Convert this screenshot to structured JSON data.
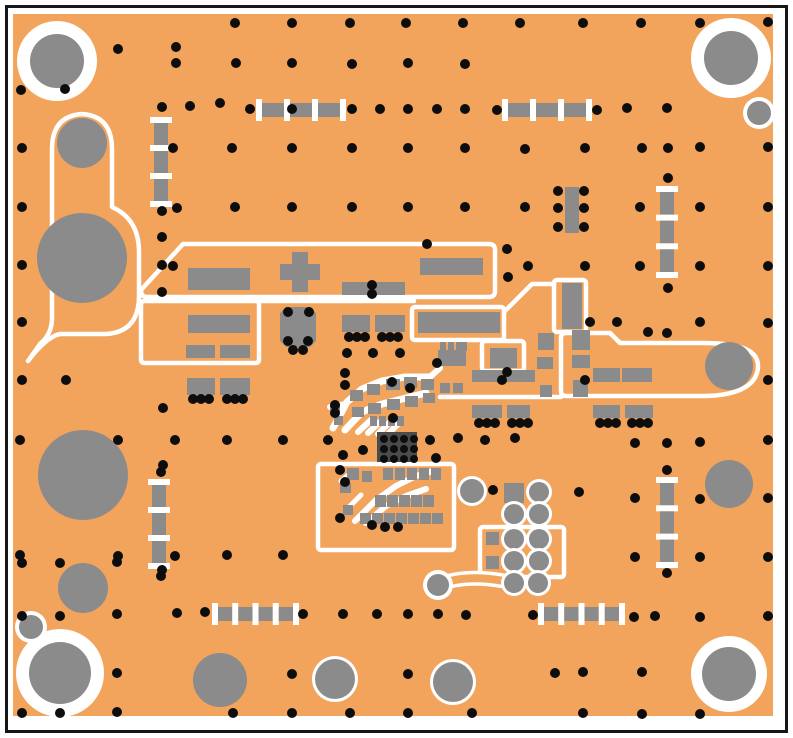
{
  "app": {
    "name": "pcb-layout-view"
  },
  "colors": {
    "background": "#ffffff",
    "frame": "#161616",
    "board_orange": "#F2A45C",
    "pad_gray": "#8B8B8B",
    "via_black": "#0D0D0D",
    "silkscreen_white": "#FFFFFF",
    "ic_grid_dark": "#4B4B4B"
  },
  "board": {
    "width": 793,
    "height": 738,
    "frame": [
      6.5,
      6.5,
      780,
      725
    ],
    "surface": [
      13,
      14,
      760,
      702
    ]
  },
  "silkscreen": {
    "paths": [
      "M28,361 Q46,337 60,334 L106,334 Q139,332 139,296 L139,252 Q139,219 112,207 L112,149 Q112,116 82,114 Q52,116 52,149 L52,318 Q52,334 40,344 L28,361",
      "M141,290 L183,244 L489,244 Q495,244 495,250 L495,291 Q495,297 489,297 L147,297 Q141,297 141,290 Z",
      "M259,301 H414",
      "M504,312 L532,284 H554",
      "M561,338 Q561,333 566,333 H610 L620,343 H702 C745,343 758,352 758,366 C758,381 745,396 702,396 H566 Q561,396 561,391 Z",
      "M440,397 H561"
    ],
    "rects": [
      [
        141,
        301,
        118,
        62
      ],
      [
        412,
        307,
        92,
        33
      ],
      [
        554,
        280,
        32,
        52
      ],
      [
        482,
        341,
        42,
        30
      ],
      [
        318,
        464,
        136,
        86
      ],
      [
        480,
        527,
        84,
        50
      ]
    ]
  },
  "traces": [
    [
      "M333,428 L347,402 L362,389 L382,381 L405,377 L430,377",
      7
    ],
    [
      "M345,430 L362,412 L382,404 L406,398 L426,393",
      7
    ],
    [
      "M358,432 L372,419",
      6
    ],
    [
      "M368,433 L382,420",
      6
    ],
    [
      "M378,434 L391,421",
      6
    ],
    [
      "M388,434 L400,422",
      6
    ],
    [
      "M330,407 L346,404",
      6
    ],
    [
      "M430,377 L440,368",
      6
    ],
    [
      "M355,521 L376,500 L396,486 L416,476 L433,471",
      6
    ],
    [
      "M366,523 L386,506 L406,496 L426,489",
      6
    ],
    [
      "M350,506 L361,495",
      5
    ],
    [
      "M341,481 L351,473",
      5
    ]
  ],
  "dumbbell": {
    "path": "M438,585 Q464,574 504,581",
    "outer": 15,
    "inner": 8,
    "pad": [
      438,
      585,
      11,
      4
    ]
  },
  "pads": [
    [
      188,
      268,
      62,
      22
    ],
    [
      292,
      252,
      16,
      40
    ],
    [
      280,
      264,
      40,
      16
    ],
    [
      342,
      282,
      63,
      13
    ],
    [
      420,
      258,
      63,
      17
    ],
    [
      188,
      315,
      62,
      18
    ],
    [
      186,
      345,
      29,
      13
    ],
    [
      220,
      345,
      30,
      13
    ],
    [
      187,
      378,
      28,
      17
    ],
    [
      220,
      378,
      30,
      17
    ],
    [
      342,
      315,
      28,
      17
    ],
    [
      375,
      315,
      30,
      17
    ],
    [
      418,
      312,
      82,
      21
    ],
    [
      438,
      350,
      28,
      16
    ],
    [
      440,
      342,
      6,
      9
    ],
    [
      448,
      342,
      6,
      9
    ],
    [
      456,
      342,
      6,
      9
    ],
    [
      462,
      342,
      5,
      9
    ],
    [
      440,
      383,
      10,
      10
    ],
    [
      453,
      383,
      10,
      10
    ],
    [
      490,
      348,
      27,
      20
    ],
    [
      472,
      370,
      30,
      12
    ],
    [
      504,
      370,
      31,
      12
    ],
    [
      538,
      333,
      16,
      17
    ],
    [
      537,
      357,
      16,
      12
    ],
    [
      540,
      385,
      12,
      12
    ],
    [
      572,
      330,
      18,
      20
    ],
    [
      572,
      355,
      18,
      13
    ],
    [
      573,
      380,
      15,
      17
    ],
    [
      593,
      368,
      27,
      14
    ],
    [
      622,
      368,
      30,
      14
    ],
    [
      472,
      405,
      30,
      13
    ],
    [
      507,
      405,
      23,
      13
    ],
    [
      593,
      405,
      27,
      13
    ],
    [
      625,
      405,
      28,
      13
    ],
    [
      562,
      283,
      20,
      46
    ],
    [
      565,
      187,
      14,
      46
    ],
    [
      350,
      390,
      13,
      11
    ],
    [
      367,
      384,
      13,
      11
    ],
    [
      386,
      379,
      14,
      11
    ],
    [
      404,
      377,
      13,
      11
    ],
    [
      421,
      379,
      13,
      11
    ],
    [
      352,
      407,
      12,
      10
    ],
    [
      368,
      403,
      13,
      11
    ],
    [
      387,
      399,
      13,
      11
    ],
    [
      405,
      396,
      13,
      11
    ],
    [
      423,
      393,
      12,
      10
    ],
    [
      370,
      416,
      7,
      10
    ],
    [
      379,
      416,
      7,
      10
    ],
    [
      388,
      416,
      7,
      10
    ],
    [
      397,
      416,
      7,
      10
    ],
    [
      330,
      403,
      10,
      9
    ],
    [
      334,
      416,
      9,
      9
    ],
    [
      347,
      468,
      12,
      12
    ],
    [
      362,
      471,
      10,
      11
    ],
    [
      383,
      468,
      10,
      12
    ],
    [
      395,
      468,
      10,
      12
    ],
    [
      407,
      468,
      10,
      12
    ],
    [
      419,
      468,
      10,
      12
    ],
    [
      431,
      468,
      10,
      12
    ],
    [
      375,
      495,
      11,
      12
    ],
    [
      387,
      495,
      11,
      12
    ],
    [
      399,
      495,
      11,
      12
    ],
    [
      411,
      495,
      11,
      12
    ],
    [
      423,
      495,
      11,
      12
    ],
    [
      340,
      483,
      11,
      10
    ],
    [
      343,
      505,
      10,
      10
    ],
    [
      360,
      513,
      11,
      11
    ],
    [
      372,
      513,
      11,
      11
    ],
    [
      384,
      513,
      11,
      11
    ],
    [
      396,
      513,
      11,
      11
    ],
    [
      408,
      513,
      11,
      11
    ],
    [
      420,
      513,
      11,
      11
    ],
    [
      432,
      513,
      11,
      11
    ],
    [
      504,
      483,
      20,
      20
    ],
    [
      486,
      532,
      13,
      13
    ],
    [
      486,
      556,
      13,
      13
    ]
  ],
  "octagon": "286,307 310,307 316,313 316,341 310,347 286,347 280,341 280,313",
  "circles": [
    [
      57,
      61,
      27,
      13
    ],
    [
      731,
      58,
      27,
      13
    ],
    [
      60,
      673,
      31,
      13
    ],
    [
      729,
      674,
      27,
      11
    ],
    [
      759,
      113,
      12,
      4
    ],
    [
      31,
      627,
      12,
      4
    ],
    [
      82,
      143,
      25,
      0
    ],
    [
      82,
      258,
      45,
      0
    ],
    [
      83,
      475,
      45,
      0
    ],
    [
      83,
      588,
      25,
      0
    ],
    [
      220,
      680,
      27,
      0
    ],
    [
      335,
      679,
      20,
      3
    ],
    [
      453,
      682,
      20,
      3
    ],
    [
      729,
      484,
      24,
      0
    ],
    [
      729,
      366,
      24,
      0
    ],
    [
      539,
      492,
      10,
      3
    ],
    [
      514,
      514,
      10,
      3
    ],
    [
      539,
      514,
      10,
      3
    ],
    [
      514,
      539,
      10,
      3
    ],
    [
      539,
      539,
      10,
      3
    ],
    [
      514,
      561,
      10,
      3
    ],
    [
      539,
      561,
      10,
      3
    ],
    [
      514,
      583,
      10,
      3
    ],
    [
      538,
      583,
      10,
      3
    ],
    [
      472,
      491,
      12,
      3
    ]
  ],
  "chains": [
    {
      "x": 256,
      "y": 103,
      "len": 90,
      "segs": 3,
      "orient": "h"
    },
    {
      "x": 502,
      "y": 103,
      "len": 90,
      "segs": 3,
      "orient": "h"
    },
    {
      "x": 212,
      "y": 607,
      "len": 87,
      "segs": 4,
      "orient": "h"
    },
    {
      "x": 538,
      "y": 607,
      "len": 87,
      "segs": 4,
      "orient": "h"
    },
    {
      "x": 154,
      "y": 117,
      "len": 90,
      "segs": 3,
      "orient": "v"
    },
    {
      "x": 660,
      "y": 186,
      "len": 92,
      "segs": 3,
      "orient": "v"
    },
    {
      "x": 152,
      "y": 479,
      "len": 90,
      "segs": 3,
      "orient": "v"
    },
    {
      "x": 660,
      "y": 477,
      "len": 91,
      "segs": 3,
      "orient": "v"
    }
  ],
  "via_grid": {
    "x": 377,
    "y": 432,
    "w": 40,
    "h": 30,
    "x0": 384,
    "y0": 439,
    "dx": 10,
    "dy": 10,
    "cols": 4,
    "rows": 3,
    "r": 4
  },
  "vias": [
    [
      235,
      23
    ],
    [
      292,
      23
    ],
    [
      350,
      23
    ],
    [
      406,
      23
    ],
    [
      463,
      23
    ],
    [
      520,
      23
    ],
    [
      583,
      23
    ],
    [
      641,
      23
    ],
    [
      700,
      23
    ],
    [
      768,
      22
    ],
    [
      118,
      49
    ],
    [
      176,
      47
    ],
    [
      176,
      63
    ],
    [
      236,
      63
    ],
    [
      292,
      63
    ],
    [
      352,
      64
    ],
    [
      408,
      63
    ],
    [
      465,
      64
    ],
    [
      21,
      90
    ],
    [
      65,
      89
    ],
    [
      162,
      107
    ],
    [
      190,
      106
    ],
    [
      220,
      103
    ],
    [
      250,
      109
    ],
    [
      292,
      109
    ],
    [
      352,
      109
    ],
    [
      380,
      109
    ],
    [
      408,
      109
    ],
    [
      437,
      109
    ],
    [
      465,
      109
    ],
    [
      497,
      110
    ],
    [
      597,
      110
    ],
    [
      627,
      108
    ],
    [
      667,
      108
    ],
    [
      22,
      148
    ],
    [
      173,
      148
    ],
    [
      232,
      148
    ],
    [
      292,
      148
    ],
    [
      352,
      148
    ],
    [
      408,
      148
    ],
    [
      465,
      148
    ],
    [
      525,
      149
    ],
    [
      585,
      148
    ],
    [
      642,
      148
    ],
    [
      668,
      148
    ],
    [
      700,
      147
    ],
    [
      768,
      147
    ],
    [
      558,
      191
    ],
    [
      584,
      191
    ],
    [
      558,
      208
    ],
    [
      584,
      208
    ],
    [
      558,
      227
    ],
    [
      584,
      227
    ],
    [
      22,
      207
    ],
    [
      177,
      208
    ],
    [
      235,
      207
    ],
    [
      292,
      207
    ],
    [
      352,
      207
    ],
    [
      408,
      207
    ],
    [
      465,
      207
    ],
    [
      525,
      207
    ],
    [
      640,
      207
    ],
    [
      700,
      207
    ],
    [
      768,
      207
    ],
    [
      162,
      211
    ],
    [
      162,
      237
    ],
    [
      427,
      244
    ],
    [
      507,
      249
    ],
    [
      508,
      277
    ],
    [
      668,
      178
    ],
    [
      22,
      265
    ],
    [
      162,
      265
    ],
    [
      173,
      266
    ],
    [
      528,
      266
    ],
    [
      585,
      266
    ],
    [
      640,
      266
    ],
    [
      700,
      266
    ],
    [
      768,
      266
    ],
    [
      668,
      288
    ],
    [
      162,
      292
    ],
    [
      22,
      322
    ],
    [
      590,
      322
    ],
    [
      617,
      322
    ],
    [
      648,
      332
    ],
    [
      667,
      333
    ],
    [
      700,
      322
    ],
    [
      768,
      323
    ],
    [
      372,
      285
    ],
    [
      372,
      294
    ],
    [
      288,
      312
    ],
    [
      309,
      312
    ],
    [
      288,
      341
    ],
    [
      308,
      341
    ],
    [
      293,
      350
    ],
    [
      303,
      350
    ],
    [
      349,
      337
    ],
    [
      357,
      337
    ],
    [
      365,
      337
    ],
    [
      382,
      337
    ],
    [
      390,
      337
    ],
    [
      398,
      337
    ],
    [
      347,
      353
    ],
    [
      373,
      353
    ],
    [
      400,
      353
    ],
    [
      193,
      399
    ],
    [
      201,
      399
    ],
    [
      209,
      399
    ],
    [
      227,
      399
    ],
    [
      235,
      399
    ],
    [
      243,
      399
    ],
    [
      479,
      423
    ],
    [
      487,
      423
    ],
    [
      495,
      423
    ],
    [
      512,
      423
    ],
    [
      520,
      423
    ],
    [
      528,
      423
    ],
    [
      600,
      423
    ],
    [
      608,
      423
    ],
    [
      616,
      423
    ],
    [
      632,
      423
    ],
    [
      640,
      423
    ],
    [
      648,
      423
    ],
    [
      22,
      380
    ],
    [
      66,
      380
    ],
    [
      585,
      380
    ],
    [
      768,
      380
    ],
    [
      345,
      385
    ],
    [
      335,
      405
    ],
    [
      335,
      413
    ],
    [
      392,
      382
    ],
    [
      410,
      388
    ],
    [
      363,
      450
    ],
    [
      343,
      455
    ],
    [
      328,
      440
    ],
    [
      393,
      418
    ],
    [
      430,
      440
    ],
    [
      458,
      438
    ],
    [
      485,
      440
    ],
    [
      515,
      438
    ],
    [
      437,
      363
    ],
    [
      502,
      380
    ],
    [
      507,
      372
    ],
    [
      345,
      373
    ],
    [
      20,
      440
    ],
    [
      118,
      440
    ],
    [
      175,
      440
    ],
    [
      227,
      440
    ],
    [
      283,
      440
    ],
    [
      635,
      443
    ],
    [
      667,
      443
    ],
    [
      700,
      442
    ],
    [
      768,
      440
    ],
    [
      163,
      408
    ],
    [
      163,
      465
    ],
    [
      161,
      472
    ],
    [
      340,
      470
    ],
    [
      345,
      482
    ],
    [
      436,
      458
    ],
    [
      493,
      490
    ],
    [
      579,
      492
    ],
    [
      667,
      470
    ],
    [
      635,
      498
    ],
    [
      700,
      499
    ],
    [
      768,
      498
    ],
    [
      20,
      555
    ],
    [
      118,
      556
    ],
    [
      175,
      556
    ],
    [
      227,
      555
    ],
    [
      283,
      555
    ],
    [
      635,
      557
    ],
    [
      700,
      557
    ],
    [
      768,
      557
    ],
    [
      161,
      576
    ],
    [
      667,
      573
    ],
    [
      340,
      518
    ],
    [
      372,
      525
    ],
    [
      385,
      527
    ],
    [
      398,
      527
    ],
    [
      22,
      563
    ],
    [
      60,
      563
    ],
    [
      117,
      562
    ],
    [
      162,
      570
    ],
    [
      22,
      616
    ],
    [
      60,
      616
    ],
    [
      117,
      614
    ],
    [
      177,
      613
    ],
    [
      205,
      612
    ],
    [
      303,
      614
    ],
    [
      343,
      614
    ],
    [
      377,
      614
    ],
    [
      408,
      614
    ],
    [
      438,
      614
    ],
    [
      466,
      615
    ],
    [
      533,
      615
    ],
    [
      634,
      617
    ],
    [
      655,
      616
    ],
    [
      700,
      617
    ],
    [
      768,
      616
    ],
    [
      292,
      674
    ],
    [
      408,
      674
    ],
    [
      555,
      673
    ],
    [
      583,
      672
    ],
    [
      642,
      672
    ],
    [
      117,
      673
    ],
    [
      22,
      713
    ],
    [
      60,
      713
    ],
    [
      117,
      712
    ],
    [
      233,
      713
    ],
    [
      292,
      713
    ],
    [
      350,
      713
    ],
    [
      408,
      713
    ],
    [
      472,
      713
    ],
    [
      583,
      713
    ],
    [
      642,
      714
    ],
    [
      700,
      714
    ]
  ]
}
